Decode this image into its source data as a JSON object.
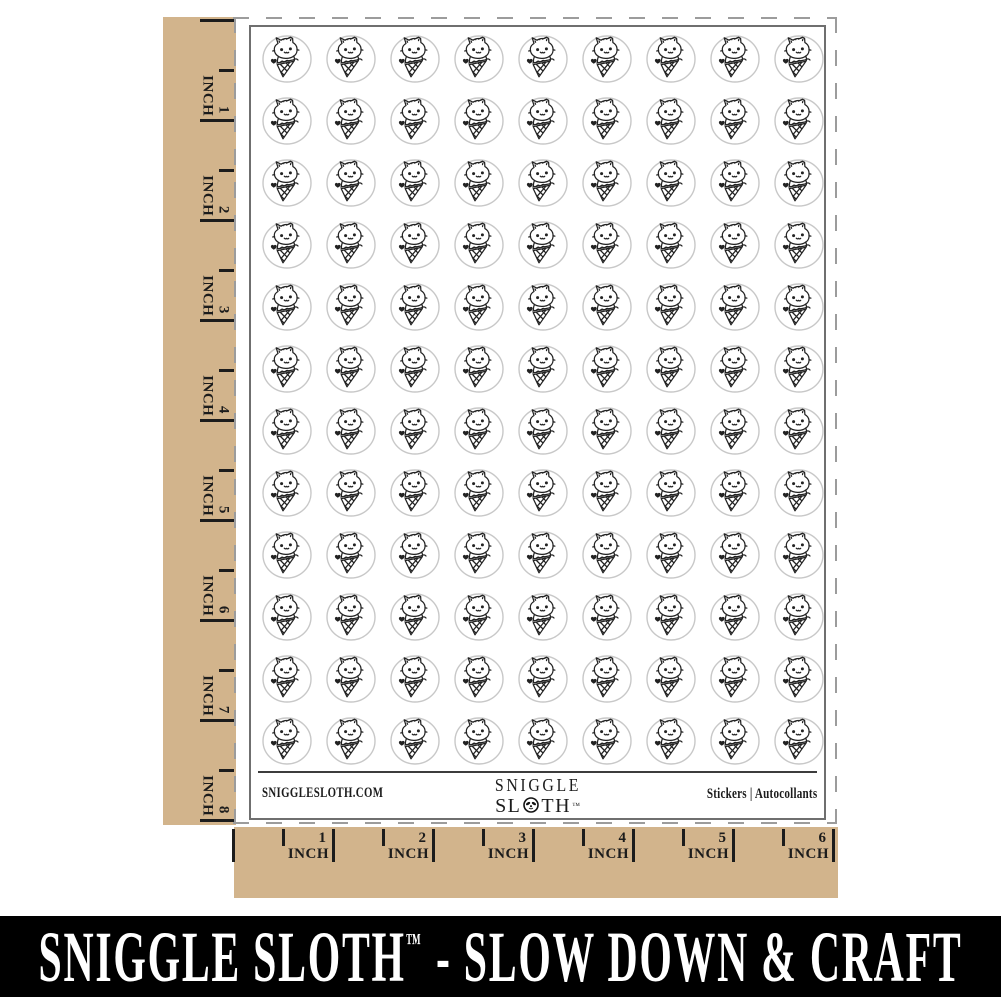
{
  "colors": {
    "kraft": "#d2b48c",
    "ink": "#1c1c1c",
    "sheet_border": "#6f6f6f",
    "cut_dash": "#9c9c9c",
    "sticker_circle_stroke": "#c8c8c8",
    "sticker_ink": "#222222",
    "footer_rule": "#3c3c3c",
    "banner_bg": "#000000",
    "banner_fg": "#ffffff"
  },
  "left_ruler": {
    "unit": "INCH",
    "marks": [
      "1",
      "2",
      "3",
      "4",
      "5",
      "6",
      "7",
      "8"
    ]
  },
  "bottom_ruler": {
    "unit": "INCH",
    "marks": [
      "1",
      "2",
      "3",
      "4",
      "5",
      "6"
    ]
  },
  "sheet": {
    "grid": {
      "rows": 12,
      "cols": 9,
      "total_stickers": 108,
      "sticker_motif": "cat-in-ice-cream-cone"
    },
    "footer": {
      "website": "SNIGGLESLOTH.COM",
      "logo": {
        "line1": "SNIGGLE",
        "line2_start": "SL",
        "line2_end": "TH",
        "tm": "™"
      },
      "right_text": "Stickers  |  Autocollants"
    }
  },
  "banner": {
    "brand": "SNIGGLE SLOTH",
    "tm": "™",
    "tagline": "- SLOW DOWN & CRAFT"
  }
}
